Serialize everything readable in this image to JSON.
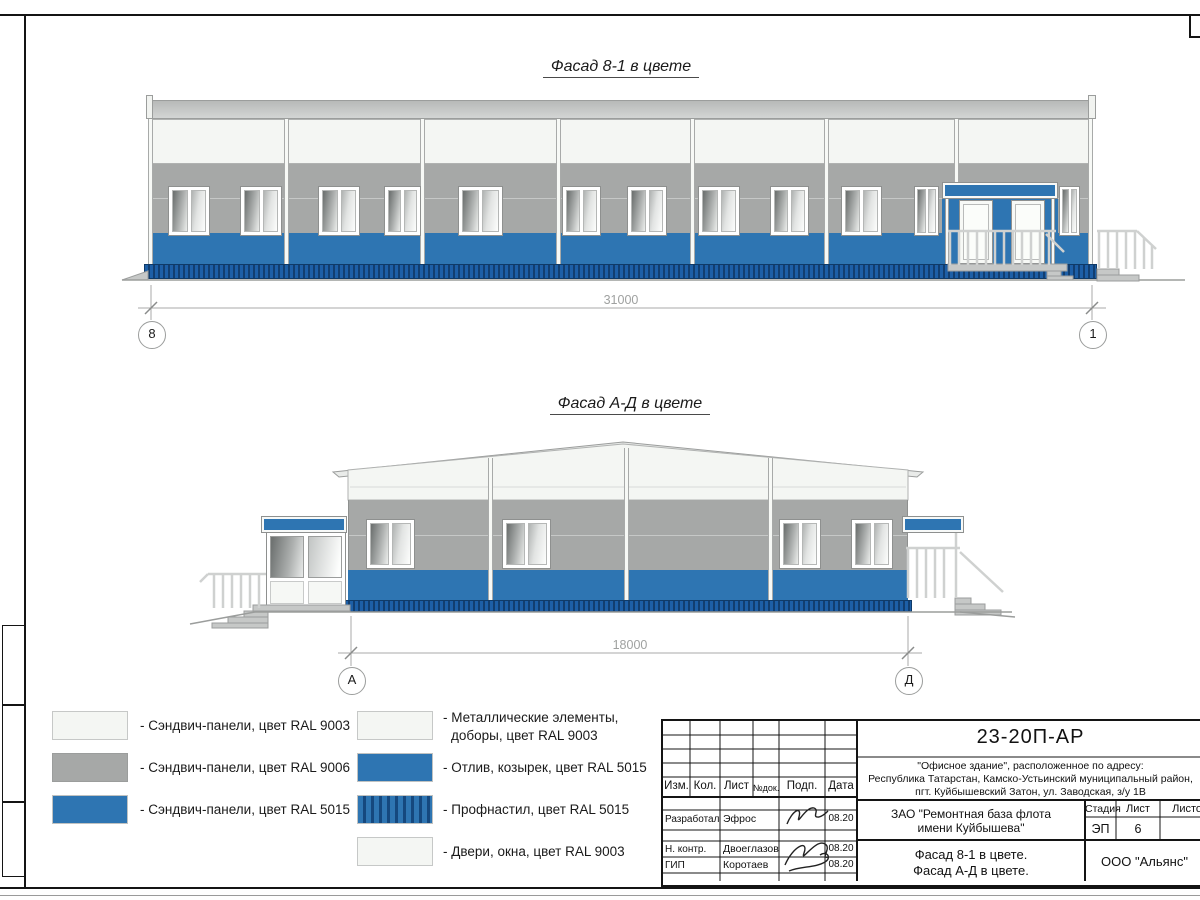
{
  "facade1": {
    "title": "Фасад 8-1 в цвете",
    "dimension_label": "31000",
    "axis_left": "8",
    "axis_right": "1"
  },
  "facade2": {
    "title": "Фасад А-Д в цвете",
    "dimension_label": "18000",
    "axis_left": "А",
    "axis_right": "Д"
  },
  "legend": {
    "left": [
      {
        "swatch": "white",
        "label": "- Сэндвич-панели, цвет RAL 9003"
      },
      {
        "swatch": "gray",
        "label": "- Сэндвич-панели, цвет RAL 9006"
      },
      {
        "swatch": "blue",
        "label": "- Сэндвич-панели, цвет RAL 5015"
      }
    ],
    "right": [
      {
        "swatch": "white",
        "label": "- Металлические элементы,",
        "label2": "доборы, цвет RAL 9003"
      },
      {
        "swatch": "blue",
        "label": "- Отлив, козырек, цвет RAL 5015"
      },
      {
        "swatch": "blue-corrugated",
        "label": "- Профнастил, цвет RAL 5015"
      },
      {
        "swatch": "white",
        "label": "- Двери, окна, цвет RAL 9003"
      }
    ]
  },
  "title_block": {
    "doc_code": "23-20П-АР",
    "address_line1": "\"Офисное здание\", расположенное по адресу:",
    "address_line2": "Республика Татарстан, Камско-Устьинский муниципальный район,",
    "address_line3": "пгт. Куйбышевский Затон, ул. Заводская, з/у 1В",
    "col_izm": "Изм.",
    "col_kol": "Кол.",
    "col_list": "Лист",
    "col_ndok": "№док.",
    "col_podp": "Подп.",
    "col_data": "Дата",
    "row1_role": "Разработал",
    "row1_name": "Эфрос",
    "row1_date": "08.20",
    "row2_role": "Н. контр.",
    "row2_name": "Двоеглазов",
    "row2_date": "08.20",
    "row3_role": "ГИП",
    "row3_name": "Коротаев",
    "row3_date": "08.20",
    "client_line1": "ЗАО \"Ремонтная база флота",
    "client_line2": "имени Куйбышева\"",
    "sheet_title_line1": "Фасад 8-1 в цвете.",
    "sheet_title_line2": "Фасад А-Д в цвете.",
    "stage_label": "Стадия",
    "list_label": "Лист",
    "listov_label": "Листов",
    "stage_value": "ЭП",
    "list_value": "6",
    "company": "ООО \"Альянс\""
  },
  "colors": {
    "panel_blue": "#2e75b2",
    "panel_gray": "#a6a8a7",
    "panel_white": "#f4f6f3",
    "corrugated_blue": "#1d5fa7"
  }
}
